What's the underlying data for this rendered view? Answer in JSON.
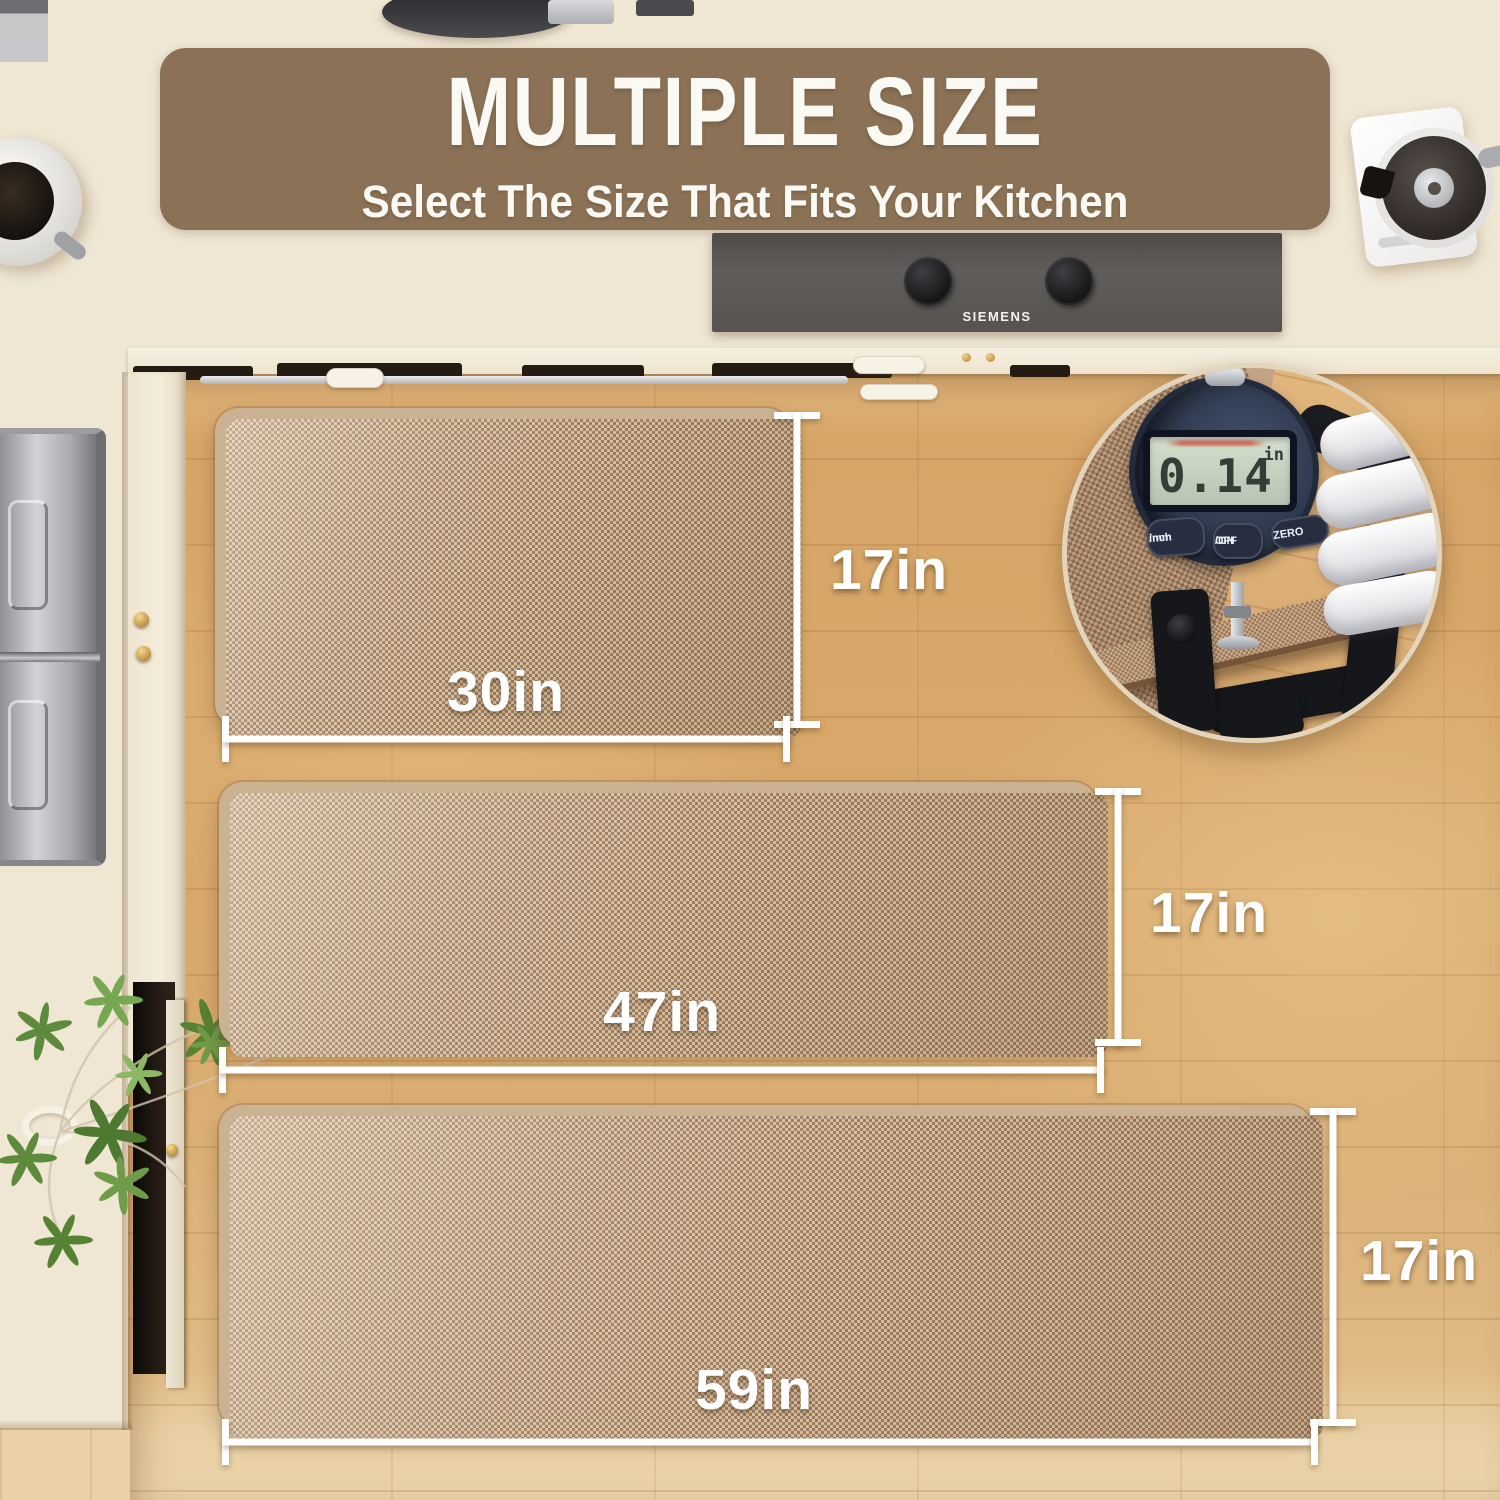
{
  "banner": {
    "title": "MULTIPLE SIZE",
    "subtitle": "Select The Size That Fits Your Kitchen",
    "bg_color": "#8B7256",
    "text_color": "#FBF9F4"
  },
  "cooktop": {
    "brand": "SIEMENS"
  },
  "mats": [
    {
      "name": "small runner",
      "width_label": "30in",
      "height_label": "17in"
    },
    {
      "name": "medium runner",
      "width_label": "47in",
      "height_label": "17in"
    },
    {
      "name": "large runner",
      "width_label": "59in",
      "height_label": "17in"
    }
  ],
  "thickness_gauge": {
    "display_value": "0.14",
    "display_unit": "in",
    "buttons": [
      {
        "line1": "inch",
        "line2": "/mm"
      },
      {
        "line1": "OFF",
        "line2": "/ON"
      },
      {
        "line1": "ZERO",
        "line2": ""
      }
    ]
  },
  "colors": {
    "banner_brown": "#8B7256",
    "annotation_white": "#FFFFFF",
    "mat_tan": "#BFA083",
    "mat_binding": "#CBB293",
    "wood_floor": "#D8A96C",
    "counter_cream": "#EFE6D4",
    "gauge_body_navy": "#2A3346",
    "lcd_green": "#C7D3C2"
  }
}
